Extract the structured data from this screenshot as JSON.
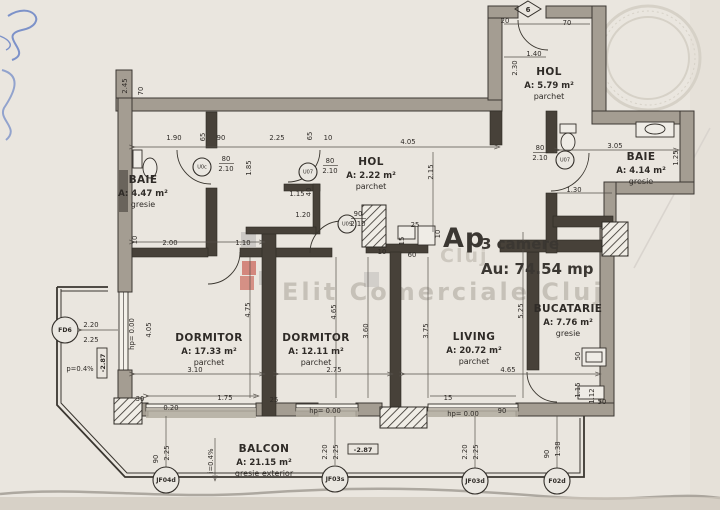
{
  "title": {
    "ap": "Ap",
    "camere": "3 camere",
    "area": "Au: 74.54 mp"
  },
  "watermark": {
    "line": "Elit Comerciale Cluj",
    "ghost": "Cluj"
  },
  "entry_axis": "6",
  "rooms": [
    {
      "name": "BAIE",
      "area": "A: 4.47 m²",
      "floor": "gresie",
      "x": 143,
      "y": 183
    },
    {
      "name": "HOL",
      "area": "A: 2.22 m²",
      "floor": "parchet",
      "x": 371,
      "y": 165
    },
    {
      "name": "HOL",
      "area": "A: 5.79 m²",
      "floor": "parchet",
      "x": 549,
      "y": 75
    },
    {
      "name": "BAIE",
      "area": "A: 4.14 m²",
      "floor": "gresie",
      "x": 641,
      "y": 160
    },
    {
      "name": "DORMITOR",
      "area": "A: 17.33 m²",
      "floor": "parchet",
      "x": 209,
      "y": 341
    },
    {
      "name": "DORMITOR",
      "area": "A: 12.11 m²",
      "floor": "parchet",
      "x": 316,
      "y": 341
    },
    {
      "name": "LIVING",
      "area": "A: 20.72 m²",
      "floor": "parchet",
      "x": 474,
      "y": 340
    },
    {
      "name": "BUCATARIE",
      "area": "A: 7.76 m²",
      "floor": "gresie",
      "x": 568,
      "y": 312
    },
    {
      "name": "BALCON",
      "area": "A: 21.15 m²",
      "floor": "gresie exterior",
      "x": 264,
      "y": 452
    }
  ],
  "markers": [
    {
      "code": "FD6",
      "x": 65,
      "y": 330
    },
    {
      "code": "JF04d",
      "x": 166,
      "y": 480
    },
    {
      "code": "JF03s",
      "x": 335,
      "y": 479
    },
    {
      "code": "JF03d",
      "x": 475,
      "y": 481
    },
    {
      "code": "F02d",
      "x": 557,
      "y": 481
    }
  ],
  "doors": [
    {
      "code": "U0c",
      "x": 202,
      "y": 167,
      "w": "80",
      "h": "2.10",
      "tx": 226,
      "ty": 161
    },
    {
      "code": "U07",
      "x": 308,
      "y": 172,
      "w": "80",
      "h": "2.10",
      "tx": 330,
      "ty": 163
    },
    {
      "code": "U09",
      "x": 347,
      "y": 224,
      "w": "90",
      "h": "2.10",
      "tx": 358,
      "ty": 216
    },
    {
      "code": "U07",
      "x": 565,
      "y": 160,
      "w": "80",
      "h": "2.10",
      "tx": 540,
      "ty": 150
    }
  ],
  "level_boxes": [
    {
      "t": "-2.87",
      "x": 363,
      "y": 451,
      "r": 0
    },
    {
      "t": "-2.87",
      "x": 104,
      "y": 363,
      "r": -90
    }
  ],
  "dimensions": [
    {
      "t": "2.45",
      "x": 127,
      "y": 86,
      "r": -90
    },
    {
      "t": "70",
      "x": 143,
      "y": 91,
      "r": -90
    },
    {
      "t": "1.90",
      "x": 174,
      "y": 140
    },
    {
      "t": "65",
      "x": 205,
      "y": 137,
      "r": -90
    },
    {
      "t": "90",
      "x": 221,
      "y": 140
    },
    {
      "t": "2.25",
      "x": 277,
      "y": 140
    },
    {
      "t": "65",
      "x": 312,
      "y": 136,
      "r": -90
    },
    {
      "t": "10",
      "x": 328,
      "y": 140
    },
    {
      "t": "4.05",
      "x": 408,
      "y": 144
    },
    {
      "t": "1.85",
      "x": 251,
      "y": 168,
      "r": -90
    },
    {
      "t": "2.15",
      "x": 433,
      "y": 172,
      "r": -90
    },
    {
      "t": "10",
      "x": 137,
      "y": 240,
      "r": -90
    },
    {
      "t": "2.00",
      "x": 170,
      "y": 245
    },
    {
      "t": "1.10",
      "x": 243,
      "y": 245
    },
    {
      "t": "1.15",
      "x": 297,
      "y": 196
    },
    {
      "t": "40",
      "x": 311,
      "y": 192,
      "r": -90
    },
    {
      "t": "1.20",
      "x": 303,
      "y": 217
    },
    {
      "t": "20",
      "x": 505,
      "y": 23
    },
    {
      "t": "70",
      "x": 567,
      "y": 25
    },
    {
      "t": "1.40",
      "x": 534,
      "y": 56
    },
    {
      "t": "2.30",
      "x": 517,
      "y": 68,
      "r": -90
    },
    {
      "t": "3.05",
      "x": 615,
      "y": 148
    },
    {
      "t": "1.30",
      "x": 574,
      "y": 192
    },
    {
      "t": "1.25",
      "x": 678,
      "y": 158,
      "r": -90
    },
    {
      "t": "25",
      "x": 415,
      "y": 227
    },
    {
      "t": "15",
      "x": 404,
      "y": 241,
      "r": -90
    },
    {
      "t": "10",
      "x": 440,
      "y": 234,
      "r": -90
    },
    {
      "t": "10",
      "x": 382,
      "y": 254
    },
    {
      "t": "60",
      "x": 412,
      "y": 257
    },
    {
      "t": "4.75",
      "x": 250,
      "y": 310,
      "r": -90
    },
    {
      "t": "4.65",
      "x": 336,
      "y": 312,
      "r": -90
    },
    {
      "t": "3.60",
      "x": 368,
      "y": 331,
      "r": -90
    },
    {
      "t": "3.75",
      "x": 428,
      "y": 331,
      "r": -90
    },
    {
      "t": "5.25",
      "x": 523,
      "y": 311,
      "r": -90
    },
    {
      "t": "3.10",
      "x": 195,
      "y": 372
    },
    {
      "t": "2.75",
      "x": 334,
      "y": 372
    },
    {
      "t": "4.65",
      "x": 508,
      "y": 372
    },
    {
      "t": "2.20",
      "x": 91,
      "y": 327
    },
    {
      "t": "2.25",
      "x": 91,
      "y": 342
    },
    {
      "t": "hp= 0.00",
      "x": 134,
      "y": 334,
      "r": -90
    },
    {
      "t": "4.05",
      "x": 151,
      "y": 330,
      "r": -90
    },
    {
      "t": "p=0.4%",
      "x": 80,
      "y": 371
    },
    {
      "t": "30",
      "x": 140,
      "y": 401
    },
    {
      "t": "1.75",
      "x": 225,
      "y": 400
    },
    {
      "t": "25",
      "x": 274,
      "y": 402
    },
    {
      "t": "0.20",
      "x": 171,
      "y": 410
    },
    {
      "t": "hp= 0.00",
      "x": 325,
      "y": 413
    },
    {
      "t": "15",
      "x": 448,
      "y": 400
    },
    {
      "t": "hp= 0.00",
      "x": 463,
      "y": 416
    },
    {
      "t": "90",
      "x": 502,
      "y": 413
    },
    {
      "t": "1.12",
      "x": 594,
      "y": 396,
      "r": -90
    },
    {
      "t": "50",
      "x": 602,
      "y": 404
    },
    {
      "t": "1.15",
      "x": 580,
      "y": 390,
      "r": -90
    },
    {
      "t": "50",
      "x": 580,
      "y": 356,
      "r": -90
    },
    {
      "t": "90",
      "x": 158,
      "y": 459,
      "r": -90
    },
    {
      "t": "2.25",
      "x": 169,
      "y": 453,
      "r": -90
    },
    {
      "t": "2.20",
      "x": 327,
      "y": 452,
      "r": -90
    },
    {
      "t": "2.25",
      "x": 338,
      "y": 452,
      "r": -90
    },
    {
      "t": "2.20",
      "x": 467,
      "y": 452,
      "r": -90
    },
    {
      "t": "2.25",
      "x": 478,
      "y": 452,
      "r": -90
    },
    {
      "t": "90",
      "x": 549,
      "y": 454,
      "r": -90
    },
    {
      "t": "1.38",
      "x": 560,
      "y": 449,
      "r": -90
    },
    {
      "t": "i=0.4%",
      "x": 213,
      "y": 461,
      "r": -90
    }
  ]
}
